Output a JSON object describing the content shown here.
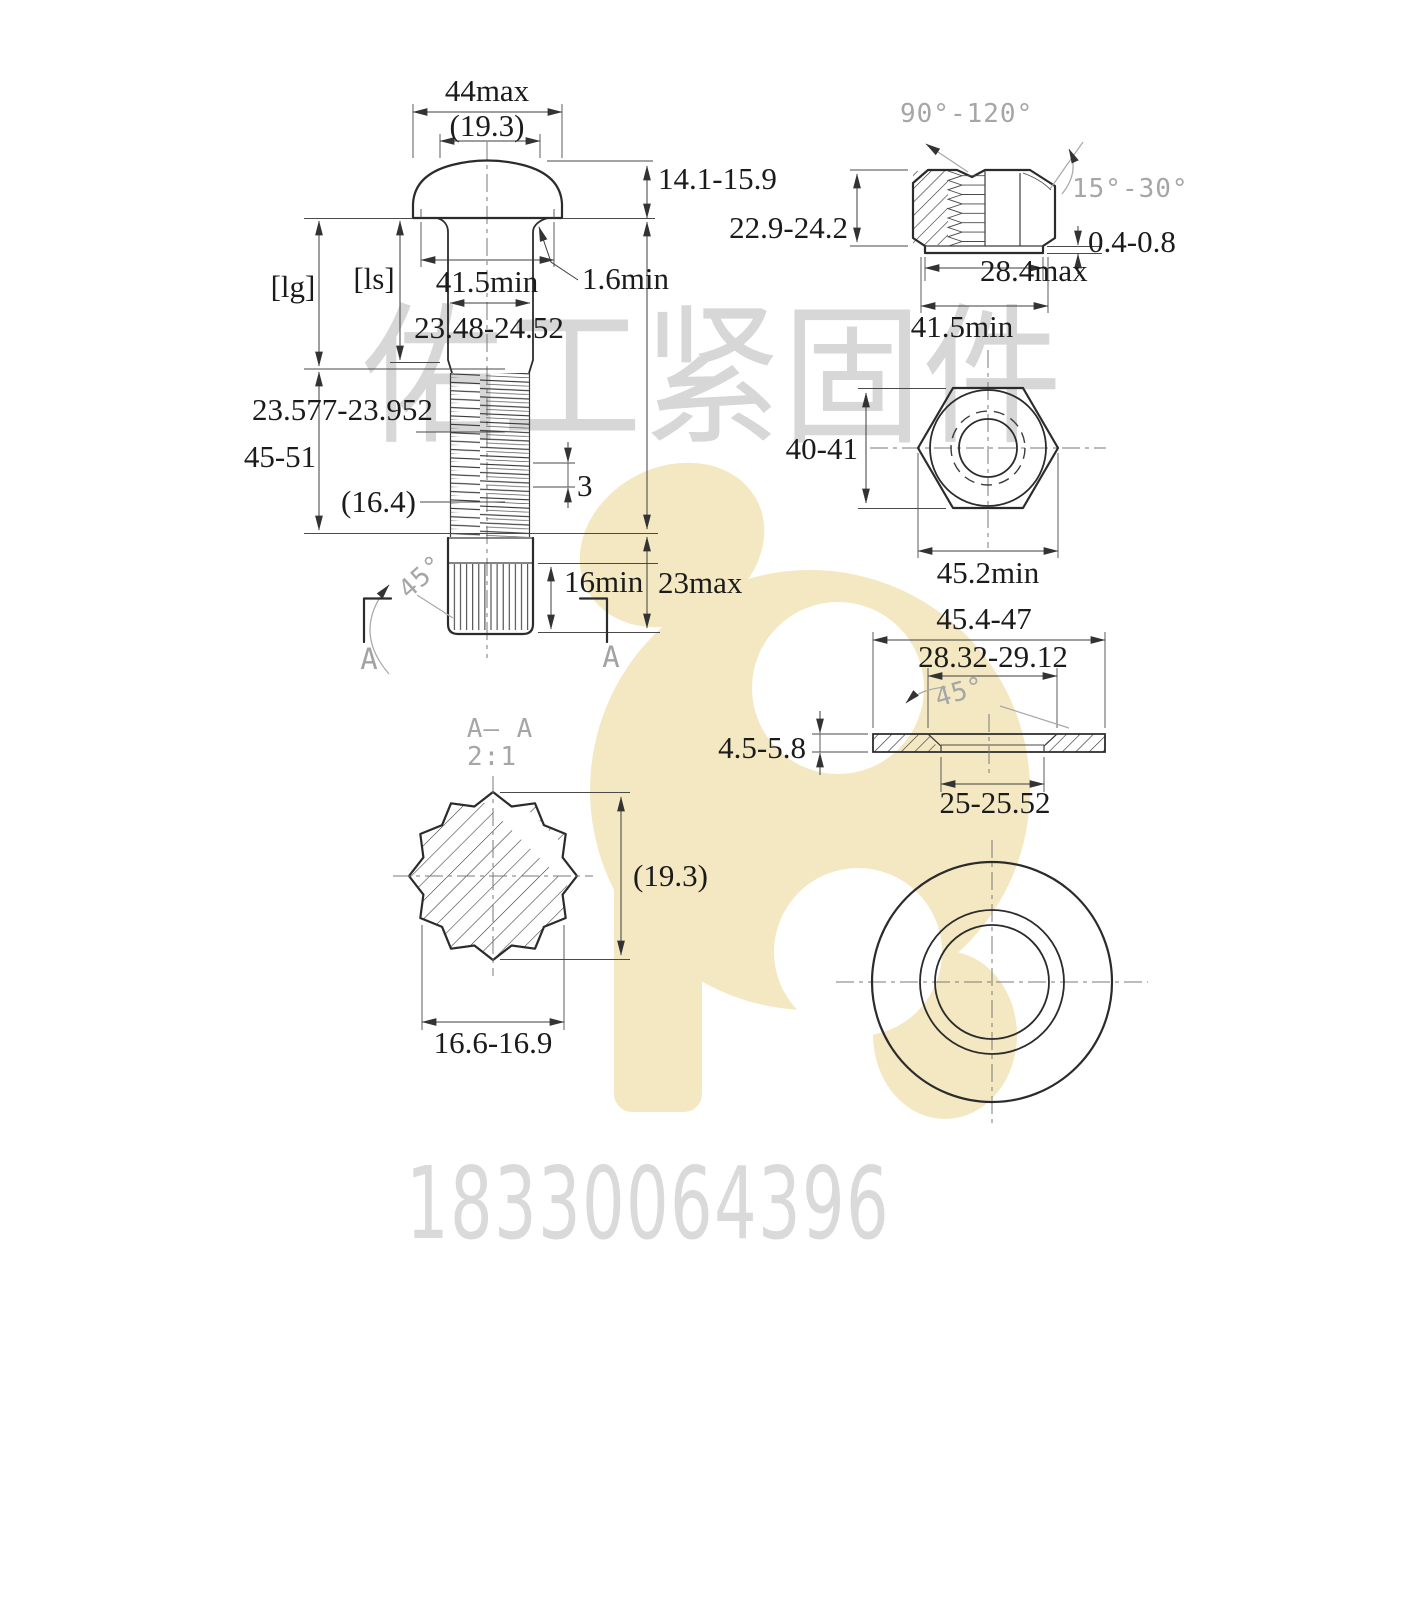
{
  "watermark": {
    "brand": "佑工紧固件",
    "phone": "18330064396"
  },
  "colors": {
    "line": "#2b2b2b",
    "dim_text": "#1b1b1b",
    "cad_text": "#a6a6a6",
    "watermark_text": "#d7d7d7",
    "logo_yellow": "#f4e8c2"
  },
  "views": {
    "bolt_front": {
      "head_width": "44max",
      "head_top_dia": "(19.3)",
      "head_height": "14.1-15.9",
      "grip_label": "[lg]",
      "shank_label": "[ls]",
      "bearing_dia": "41.5min",
      "fillet": "1.6min",
      "shank_dia": "23.48-24.52",
      "thread_dia": "23.577-23.952",
      "thread_length": "45-51",
      "spline_dia": "(16.4)",
      "pitch": "3",
      "chamfer_angle": "45°",
      "spline_length": "16min",
      "point_length": "23max",
      "section_left": "A",
      "section_right": "A"
    },
    "nut_section": {
      "countersink_angle": "90°-120°",
      "chamfer_angle": "15°-30°",
      "height": "22.9-24.2",
      "washer_face_height": "0.4-0.8",
      "washer_face_dia": "28.4max",
      "bearing_dia": "41.5min"
    },
    "nut_top": {
      "across_flats": "40-41",
      "across_corners": "45.2min"
    },
    "washer_section": {
      "outer_dia": "45.4-47",
      "chamfer_dia": "28.32-29.12",
      "chamfer_angle": "45°",
      "thickness": "4.5-5.8",
      "hole_dia": "25-25.52"
    },
    "spline_section": {
      "title": "A— A",
      "scale": "2:1",
      "tip_dia": "(19.3)",
      "across_flats": "16.6-16.9"
    }
  }
}
